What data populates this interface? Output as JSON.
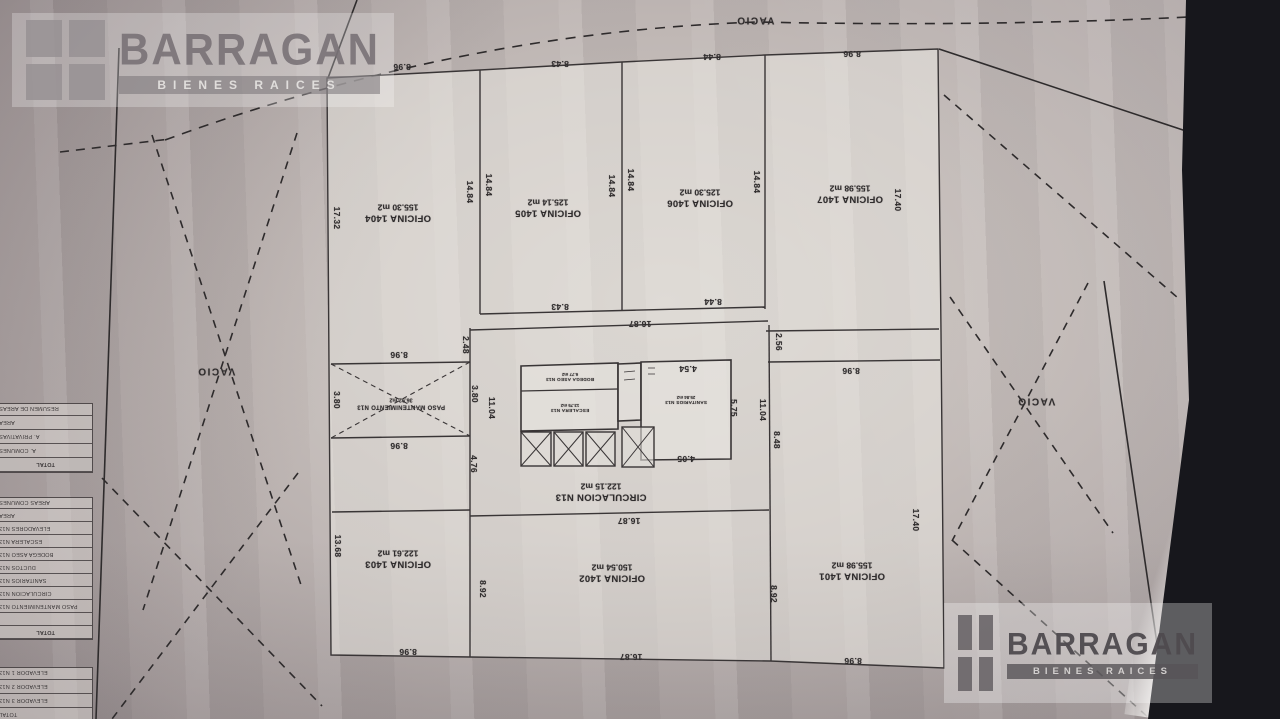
{
  "brand": {
    "name": "BARRAGAN",
    "subtitle": "BIENES RAICES"
  },
  "colors": {
    "paper": "#c2bab7",
    "paper_light": "#d0cac6",
    "paper_dark": "#9e9596",
    "plan_line": "#393536",
    "site_line": "#2e2b2c",
    "ink": "#2f2c2d",
    "dark_edge": "#17171c",
    "logo_gray": "#767074"
  },
  "plan": {
    "rooms": [
      {
        "name": "OFICINA 1404",
        "area": "155.30 m2",
        "x": 398,
        "y": 212,
        "r": 180,
        "size": "lg"
      },
      {
        "name": "OFICINA 1405",
        "area": "125.14 m2",
        "x": 548,
        "y": 207,
        "r": 180,
        "size": "lg"
      },
      {
        "name": "OFICINA 1406",
        "area": "125.30 m2",
        "x": 700,
        "y": 197,
        "r": 180,
        "size": "lg"
      },
      {
        "name": "OFICINA 1407",
        "area": "155.98 m2",
        "x": 850,
        "y": 193,
        "r": 180,
        "size": "lg"
      },
      {
        "name": "OFICINA 1403",
        "area": "122.61 m2",
        "x": 398,
        "y": 558,
        "r": 180,
        "size": "lg"
      },
      {
        "name": "OFICINA 1402",
        "area": "150.54 m2",
        "x": 612,
        "y": 572,
        "r": 180,
        "size": "lg"
      },
      {
        "name": "OFICINA 1401",
        "area": "155.98 m2",
        "x": 852,
        "y": 570,
        "r": 180,
        "size": "lg"
      },
      {
        "name": "PASO MANTENIMIENTO N13",
        "area": "36.92 m2",
        "x": 401,
        "y": 403,
        "r": 180,
        "size": "sm"
      },
      {
        "name": "CIRCULACION N13",
        "area": "122.15 m2",
        "x": 601,
        "y": 491,
        "r": 180,
        "size": "lg"
      },
      {
        "name": "BODEGA ASEO N13",
        "area": "6.77 m2",
        "x": 570,
        "y": 377,
        "r": 180,
        "size": "xs"
      },
      {
        "name": "ESCALERA N13",
        "area": "13.75 m2",
        "x": 570,
        "y": 408,
        "r": 180,
        "size": "xs"
      },
      {
        "name": "SANITARIOS N13",
        "area": "25.84 m2",
        "x": 686,
        "y": 400,
        "r": 180,
        "size": "xs"
      }
    ],
    "vacio_labels": [
      {
        "text": "VACIO",
        "x": 755,
        "y": 20,
        "r": 180
      },
      {
        "text": "VACIO",
        "x": 216,
        "y": 371,
        "r": 180
      },
      {
        "text": "VACIO",
        "x": 1036,
        "y": 401,
        "r": 180
      }
    ],
    "dimensions": [
      {
        "t": "8.96",
        "x": 402,
        "y": 67,
        "r": 180
      },
      {
        "t": "8.43",
        "x": 560,
        "y": 64,
        "r": 180
      },
      {
        "t": "8.44",
        "x": 712,
        "y": 57,
        "r": 180
      },
      {
        "t": "8.96",
        "x": 852,
        "y": 54,
        "r": 180
      },
      {
        "t": "17.32",
        "x": 337,
        "y": 218,
        "r": 90
      },
      {
        "t": "13.68",
        "x": 338,
        "y": 546,
        "r": 90
      },
      {
        "t": "14.84",
        "x": 470,
        "y": 192,
        "r": 90
      },
      {
        "t": "14.84",
        "x": 489,
        "y": 185,
        "r": 90
      },
      {
        "t": "14.84",
        "x": 612,
        "y": 186,
        "r": 90
      },
      {
        "t": "14.84",
        "x": 631,
        "y": 180,
        "r": 90
      },
      {
        "t": "14.84",
        "x": 757,
        "y": 182,
        "r": 90
      },
      {
        "t": "17.40",
        "x": 898,
        "y": 200,
        "r": 90
      },
      {
        "t": "8.43",
        "x": 560,
        "y": 307,
        "r": 180
      },
      {
        "t": "8.44",
        "x": 713,
        "y": 302,
        "r": 180
      },
      {
        "t": "16.87",
        "x": 640,
        "y": 324,
        "r": 180
      },
      {
        "t": "2.48",
        "x": 466,
        "y": 345,
        "r": 90
      },
      {
        "t": "2.56",
        "x": 779,
        "y": 342,
        "r": 90
      },
      {
        "t": "8.96",
        "x": 399,
        "y": 355,
        "r": 180
      },
      {
        "t": "8.96",
        "x": 399,
        "y": 446,
        "r": 180
      },
      {
        "t": "3.80",
        "x": 337,
        "y": 400,
        "r": 90
      },
      {
        "t": "3.80",
        "x": 475,
        "y": 394,
        "r": 90
      },
      {
        "t": "11.04",
        "x": 492,
        "y": 408,
        "r": 90
      },
      {
        "t": "4.54",
        "x": 688,
        "y": 369,
        "r": 180
      },
      {
        "t": "5.75",
        "x": 734,
        "y": 408,
        "r": 90
      },
      {
        "t": "11.04",
        "x": 763,
        "y": 410,
        "r": 90
      },
      {
        "t": "8.48",
        "x": 777,
        "y": 440,
        "r": 90
      },
      {
        "t": "4.05",
        "x": 686,
        "y": 459,
        "r": 180
      },
      {
        "t": "4.76",
        "x": 474,
        "y": 464,
        "r": 90
      },
      {
        "t": "8.96",
        "x": 851,
        "y": 371,
        "r": 180
      },
      {
        "t": "16.87",
        "x": 629,
        "y": 521,
        "r": 180
      },
      {
        "t": "8.92",
        "x": 483,
        "y": 589,
        "r": 90
      },
      {
        "t": "8.92",
        "x": 774,
        "y": 594,
        "r": 90
      },
      {
        "t": "17.40",
        "x": 916,
        "y": 520,
        "r": 90
      },
      {
        "t": "8.96",
        "x": 408,
        "y": 652,
        "r": 180
      },
      {
        "t": "16.87",
        "x": 631,
        "y": 657,
        "r": 180
      },
      {
        "t": "8.96",
        "x": 853,
        "y": 661,
        "r": 180
      }
    ]
  },
  "side_tables": {
    "x": -5,
    "width": 98,
    "tables": [
      {
        "id": "area-summary-table",
        "y": 403,
        "row_h": 14,
        "header": "RESUMEN DE AREAS",
        "rows": [
          "AREA",
          "A. PRIVATIVAS",
          "A. COMUNES",
          "TOTAL"
        ]
      },
      {
        "id": "common-areas-table",
        "y": 497,
        "row_h": 13,
        "header": "AREAS COMUNES",
        "rows": [
          "AREA",
          "ELEVADORES N13",
          "ESCALERA N13",
          "BODEGA ASEO N13",
          "DUCTOS N13",
          "SANITARIOS N13",
          "CIRCULACION N13",
          "PASO MANTENIMIENTO N13",
          "",
          "TOTAL"
        ]
      },
      {
        "id": "elevators-table",
        "y": 667,
        "row_h": 14,
        "header": "",
        "rows": [
          "ELEVADOR 1 N13",
          "ELEVADOR 2 N13",
          "ELEVADOR 3 N13",
          "TOTAL"
        ]
      }
    ]
  }
}
